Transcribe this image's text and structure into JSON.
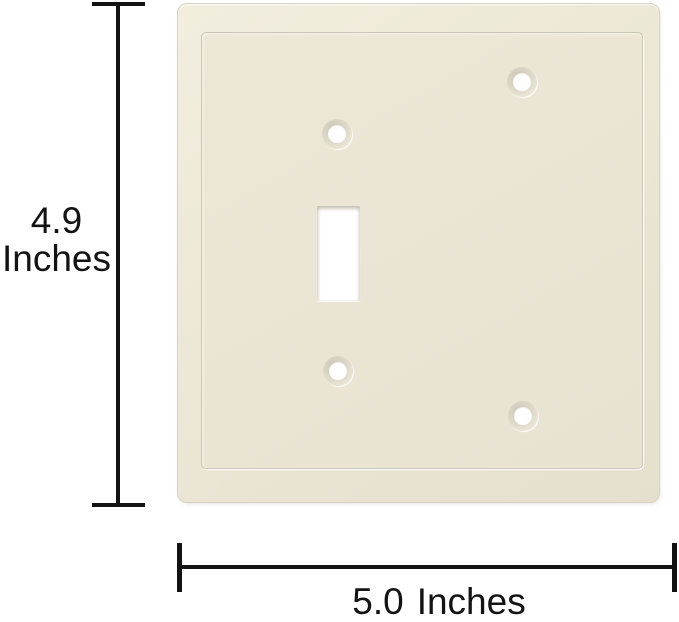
{
  "figure": {
    "background_color": "#ffffff",
    "annotation_color": "#131313"
  },
  "plate": {
    "description": "wall plate with one toggle switch cutout, one blank half and four screw holes",
    "color": "#eae5d4",
    "screw_holes": 4
  },
  "dimensions": {
    "height": {
      "value": "4.9",
      "unit": "Inches"
    },
    "width": {
      "value": "5.0",
      "unit": "Inches"
    }
  }
}
